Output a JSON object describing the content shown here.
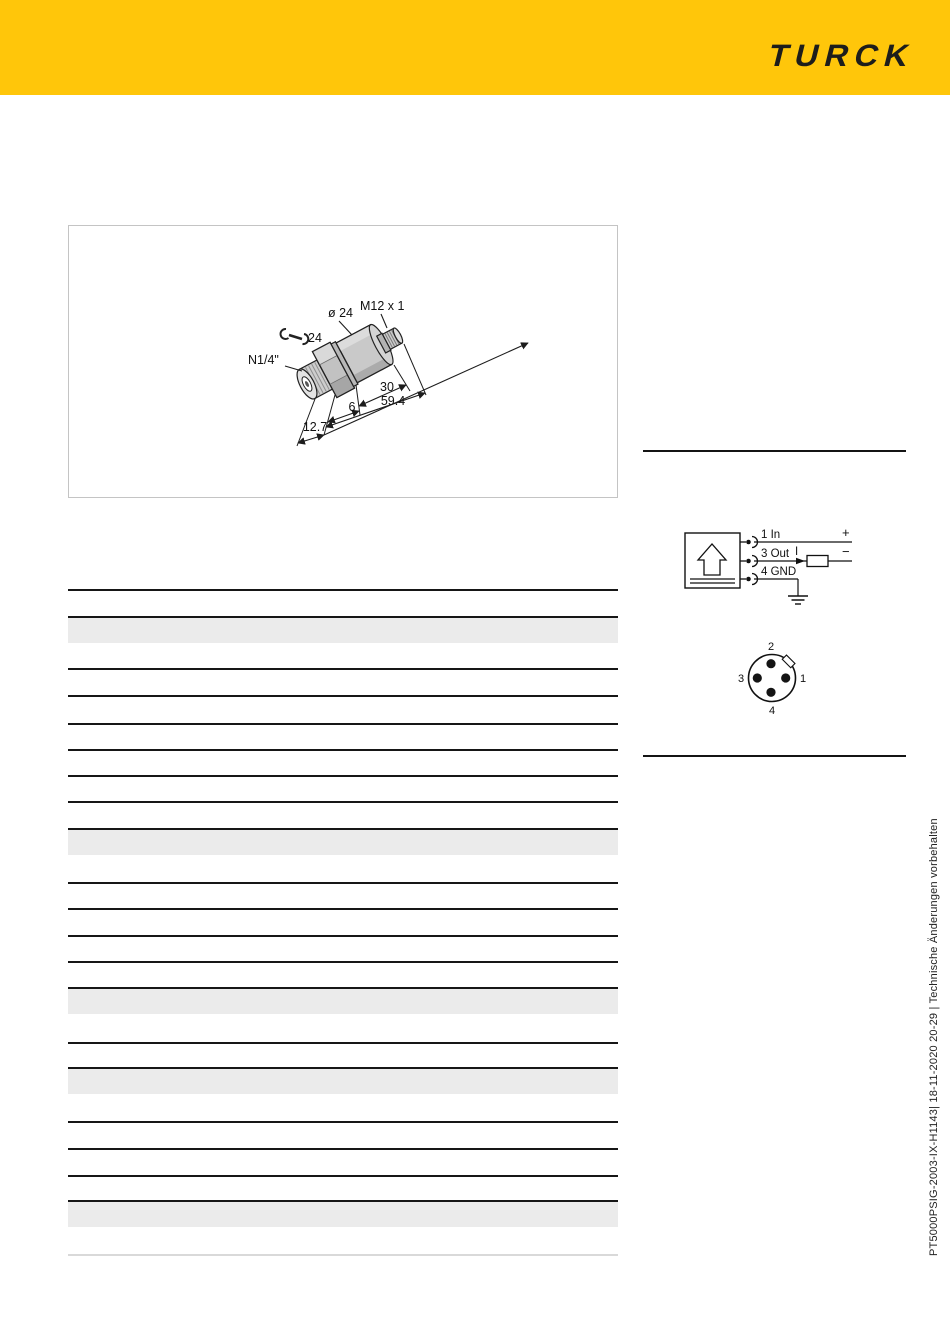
{
  "brand": {
    "logo_text": "TURCK",
    "banner_color": "#ffc60a",
    "logo_color": "#1d1d1b"
  },
  "dimension_drawing": {
    "connector_thread": "M12 x 1",
    "body_diameter": "ø 24",
    "wrench_size": "24",
    "process_connection": "N1/4\"",
    "body_length": "30",
    "total_length": "59.4",
    "hex_length": "6",
    "thread_length": "12.7"
  },
  "wiring_diagram": {
    "pin1_label": "1 In",
    "pin3_label": "3 Out",
    "pin4_label": "4 GND",
    "plus": "+",
    "minus": "−",
    "current_symbol": "I"
  },
  "connector_pinout": {
    "pin_top": "2",
    "pin_left": "3",
    "pin_right": "1",
    "pin_bottom": "4"
  },
  "footer_note": "PT5000PSIG-2003-IX-H1143| 18-11-2020 20-29 | Technische Änderungen vorbehalten",
  "table": {
    "note": "spec table rendered without text",
    "row_band_color": "#ebebeb",
    "rule_color": "#161616"
  }
}
